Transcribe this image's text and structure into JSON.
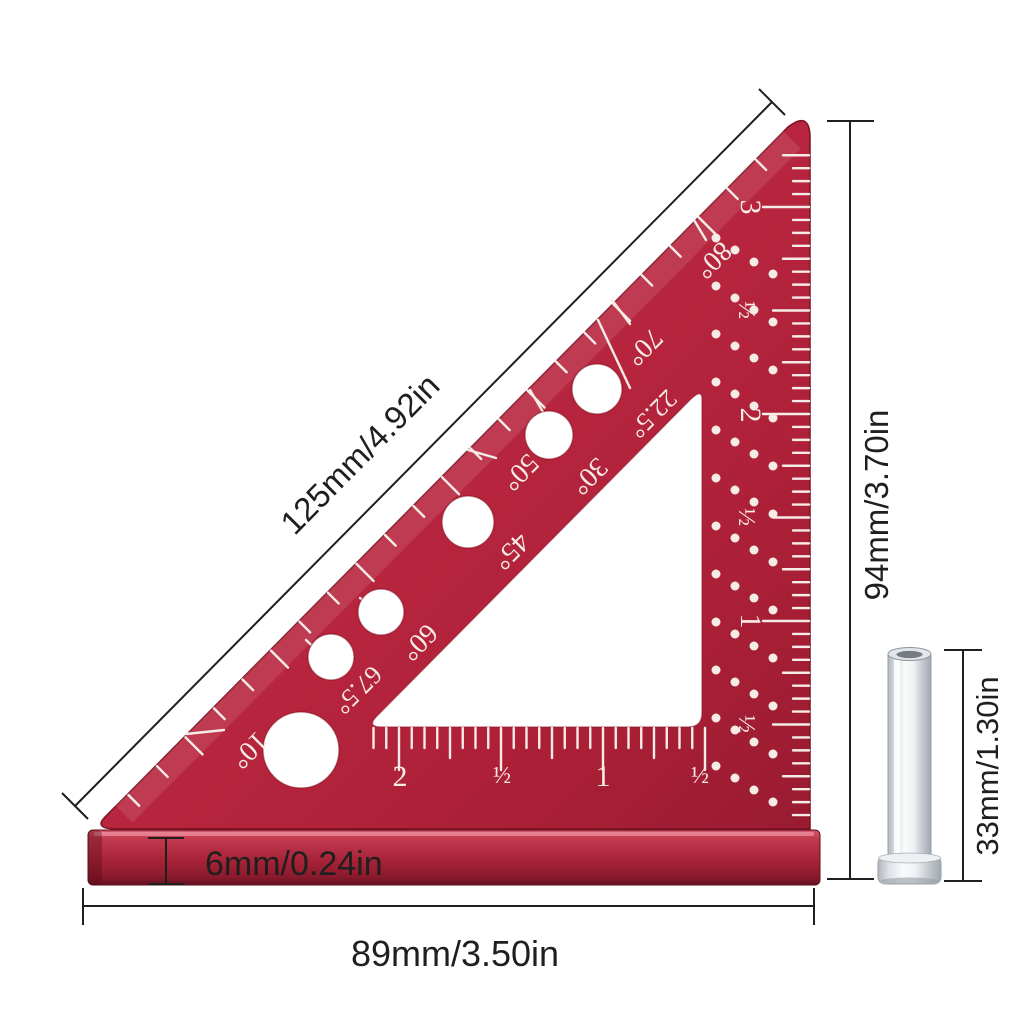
{
  "colors": {
    "background": "#ffffff",
    "dimension": "#1f1f1f",
    "marking": "#f6ece7",
    "body": "#bb2640",
    "body_dark": "#991b30",
    "bar_bottom": "#651122",
    "pin": "#d9dde1"
  },
  "annotations": {
    "hypotenuse": "125mm/4.92in",
    "height": "94mm/3.70in",
    "pin": "33mm/1.30in",
    "thickness": "6mm/0.24in",
    "base": "89mm/3.50in"
  },
  "square": {
    "angle_labels": [
      "10°",
      "60°",
      "67.5°",
      "45°",
      "50°",
      "30°",
      "22.5°",
      "70°",
      "80°"
    ],
    "right_scale": [
      "3",
      "½",
      "2",
      "½",
      "1",
      "½"
    ],
    "bottom_scale": [
      "2",
      "½",
      "1",
      "½"
    ]
  }
}
